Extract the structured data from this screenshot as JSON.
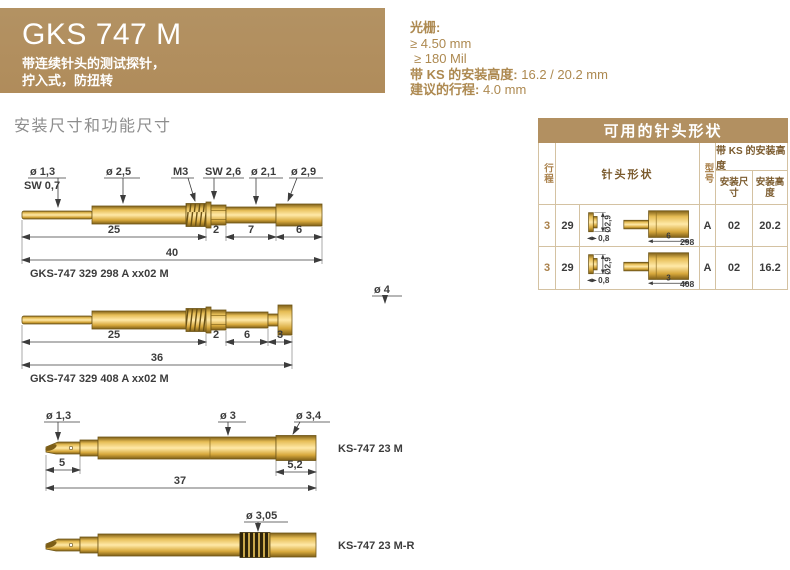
{
  "header": {
    "title": "GKS 747 M",
    "subtitle_line1": "带连续针头的测试探针，",
    "subtitle_line2": "拧入式，防扭转"
  },
  "specs": {
    "grid_label": "光栅:",
    "grid_mm": "≥ 4.50 mm",
    "grid_mil": "≥ 180 Mil",
    "mount_label": "带 KS 的安装高度:",
    "mount_value": "16.2 / 20.2 mm",
    "travel_label": "建议的行程:",
    "travel_value": "4.0 mm"
  },
  "section_title": "安装尺寸和功能尺寸",
  "drawings": {
    "d1": {
      "labels": {
        "dia_tip": "ø 1,3",
        "sw_tip": "SW 0,7",
        "dia_barrel": "ø 2,5",
        "thread": "M3",
        "sw_hex": "SW 2,6",
        "dia_mid": "ø 2,1",
        "dia_end": "ø 2,9"
      },
      "dims": {
        "a": "25",
        "b": "2",
        "c": "7",
        "d": "6",
        "total": "40"
      },
      "caption": "GKS-747 329 298 A xx02 M"
    },
    "d2": {
      "labels": {
        "dia_flange": "ø 4"
      },
      "dims": {
        "a": "25",
        "b": "2",
        "c": "6",
        "d": "3",
        "total": "36"
      },
      "caption": "GKS-747 329 408 A xx02 M"
    },
    "d3": {
      "labels": {
        "dia_tip": "ø 1,3",
        "dia_body": "ø 3",
        "dia_end": "ø 3,4"
      },
      "dims": {
        "a": "5",
        "b": "5,2",
        "total": "37"
      },
      "caption": "KS-747 23 M"
    },
    "d4": {
      "labels": {
        "dia_knurl": "ø 3,05"
      },
      "caption": "KS-747 23 M-R"
    }
  },
  "table": {
    "title": "可用的针头形状",
    "col_travel": "行程",
    "col_tip_shape": "针头形状",
    "col_type": "型号",
    "col_mount_group": "带 KS 的安装高度",
    "col_mount_dim": "安装尺寸",
    "col_mount_height": "安装高度",
    "rows": [
      {
        "travel": "3",
        "spring": "29",
        "tip_dia": "Ø2,9",
        "dim1": "0,8",
        "dim2": "6",
        "code": "298",
        "type": "A",
        "mount_dim": "02",
        "mount_height": "20.2"
      },
      {
        "travel": "3",
        "spring": "29",
        "tip_dia": "Ø2,9",
        "dim1": "0,8",
        "dim2": "3",
        "code": "408",
        "type": "A",
        "mount_dim": "02",
        "mount_height": "16.2"
      }
    ]
  },
  "colors": {
    "accent": "#b29061",
    "gold_light": "#ffe9a8",
    "gold_dark": "#7d5e17",
    "dim_text": "#3c3c3c",
    "table_border": "#d4c2a2"
  }
}
